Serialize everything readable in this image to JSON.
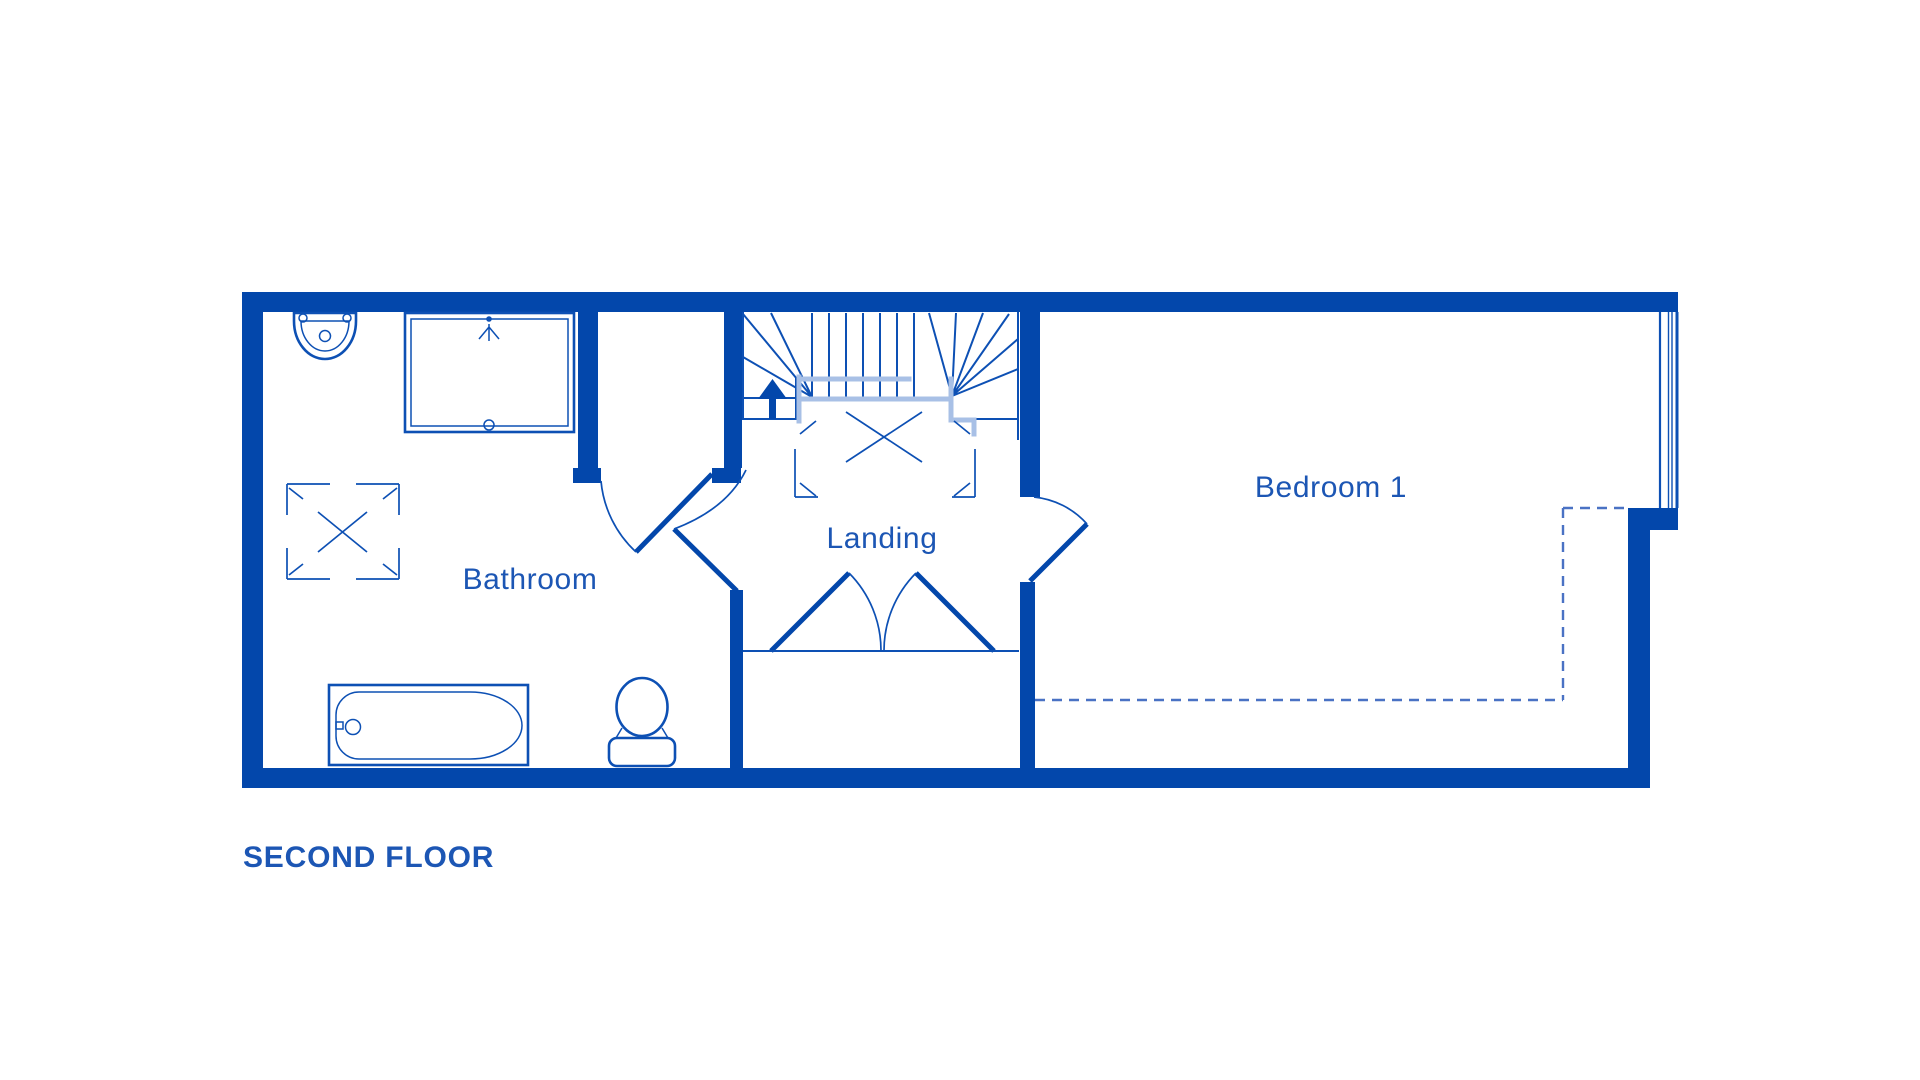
{
  "floor": {
    "title": "SECOND FLOOR"
  },
  "rooms": [
    {
      "id": "bathroom",
      "label": "Bathroom"
    },
    {
      "id": "landing",
      "label": "Landing"
    },
    {
      "id": "bedroom1",
      "label": "Bedroom 1"
    }
  ],
  "fixtures": [
    {
      "id": "sink",
      "name": "wash-basin with two taps"
    },
    {
      "id": "shower-enclosure",
      "name": "shower enclosure with shower-head symbol"
    },
    {
      "id": "bathroom-rooflight",
      "name": "rooflight symbol (square with X)"
    },
    {
      "id": "bath",
      "name": "bath tub with tap"
    },
    {
      "id": "toilet",
      "name": "toilet with cistern"
    },
    {
      "id": "stairs",
      "name": "winder staircase",
      "direction_icon": "up-arrow"
    },
    {
      "id": "stair-void",
      "name": "stair void rooflight symbol (square with X)"
    },
    {
      "id": "bathroom-door",
      "name": "bathroom door with swing arc"
    },
    {
      "id": "cupboard-door",
      "name": "cupboard door with swing arc"
    },
    {
      "id": "eaves-storage",
      "name": "eaves storage with double doors"
    },
    {
      "id": "bedroom-door",
      "name": "bedroom door with swing arc"
    },
    {
      "id": "window",
      "name": "window on right wall"
    },
    {
      "id": "reduced-headroom",
      "name": "reduced headroom dashed outline"
    }
  ],
  "colors": {
    "wall": "#0347ab",
    "line": "#0d50b4",
    "fixture": "#0d50b4",
    "pale_rail": "#a8c0e6",
    "label_text": "#1c56b4",
    "title_text": "#1c56b4",
    "dashed": "#4a72c4",
    "background": "#ffffff"
  }
}
